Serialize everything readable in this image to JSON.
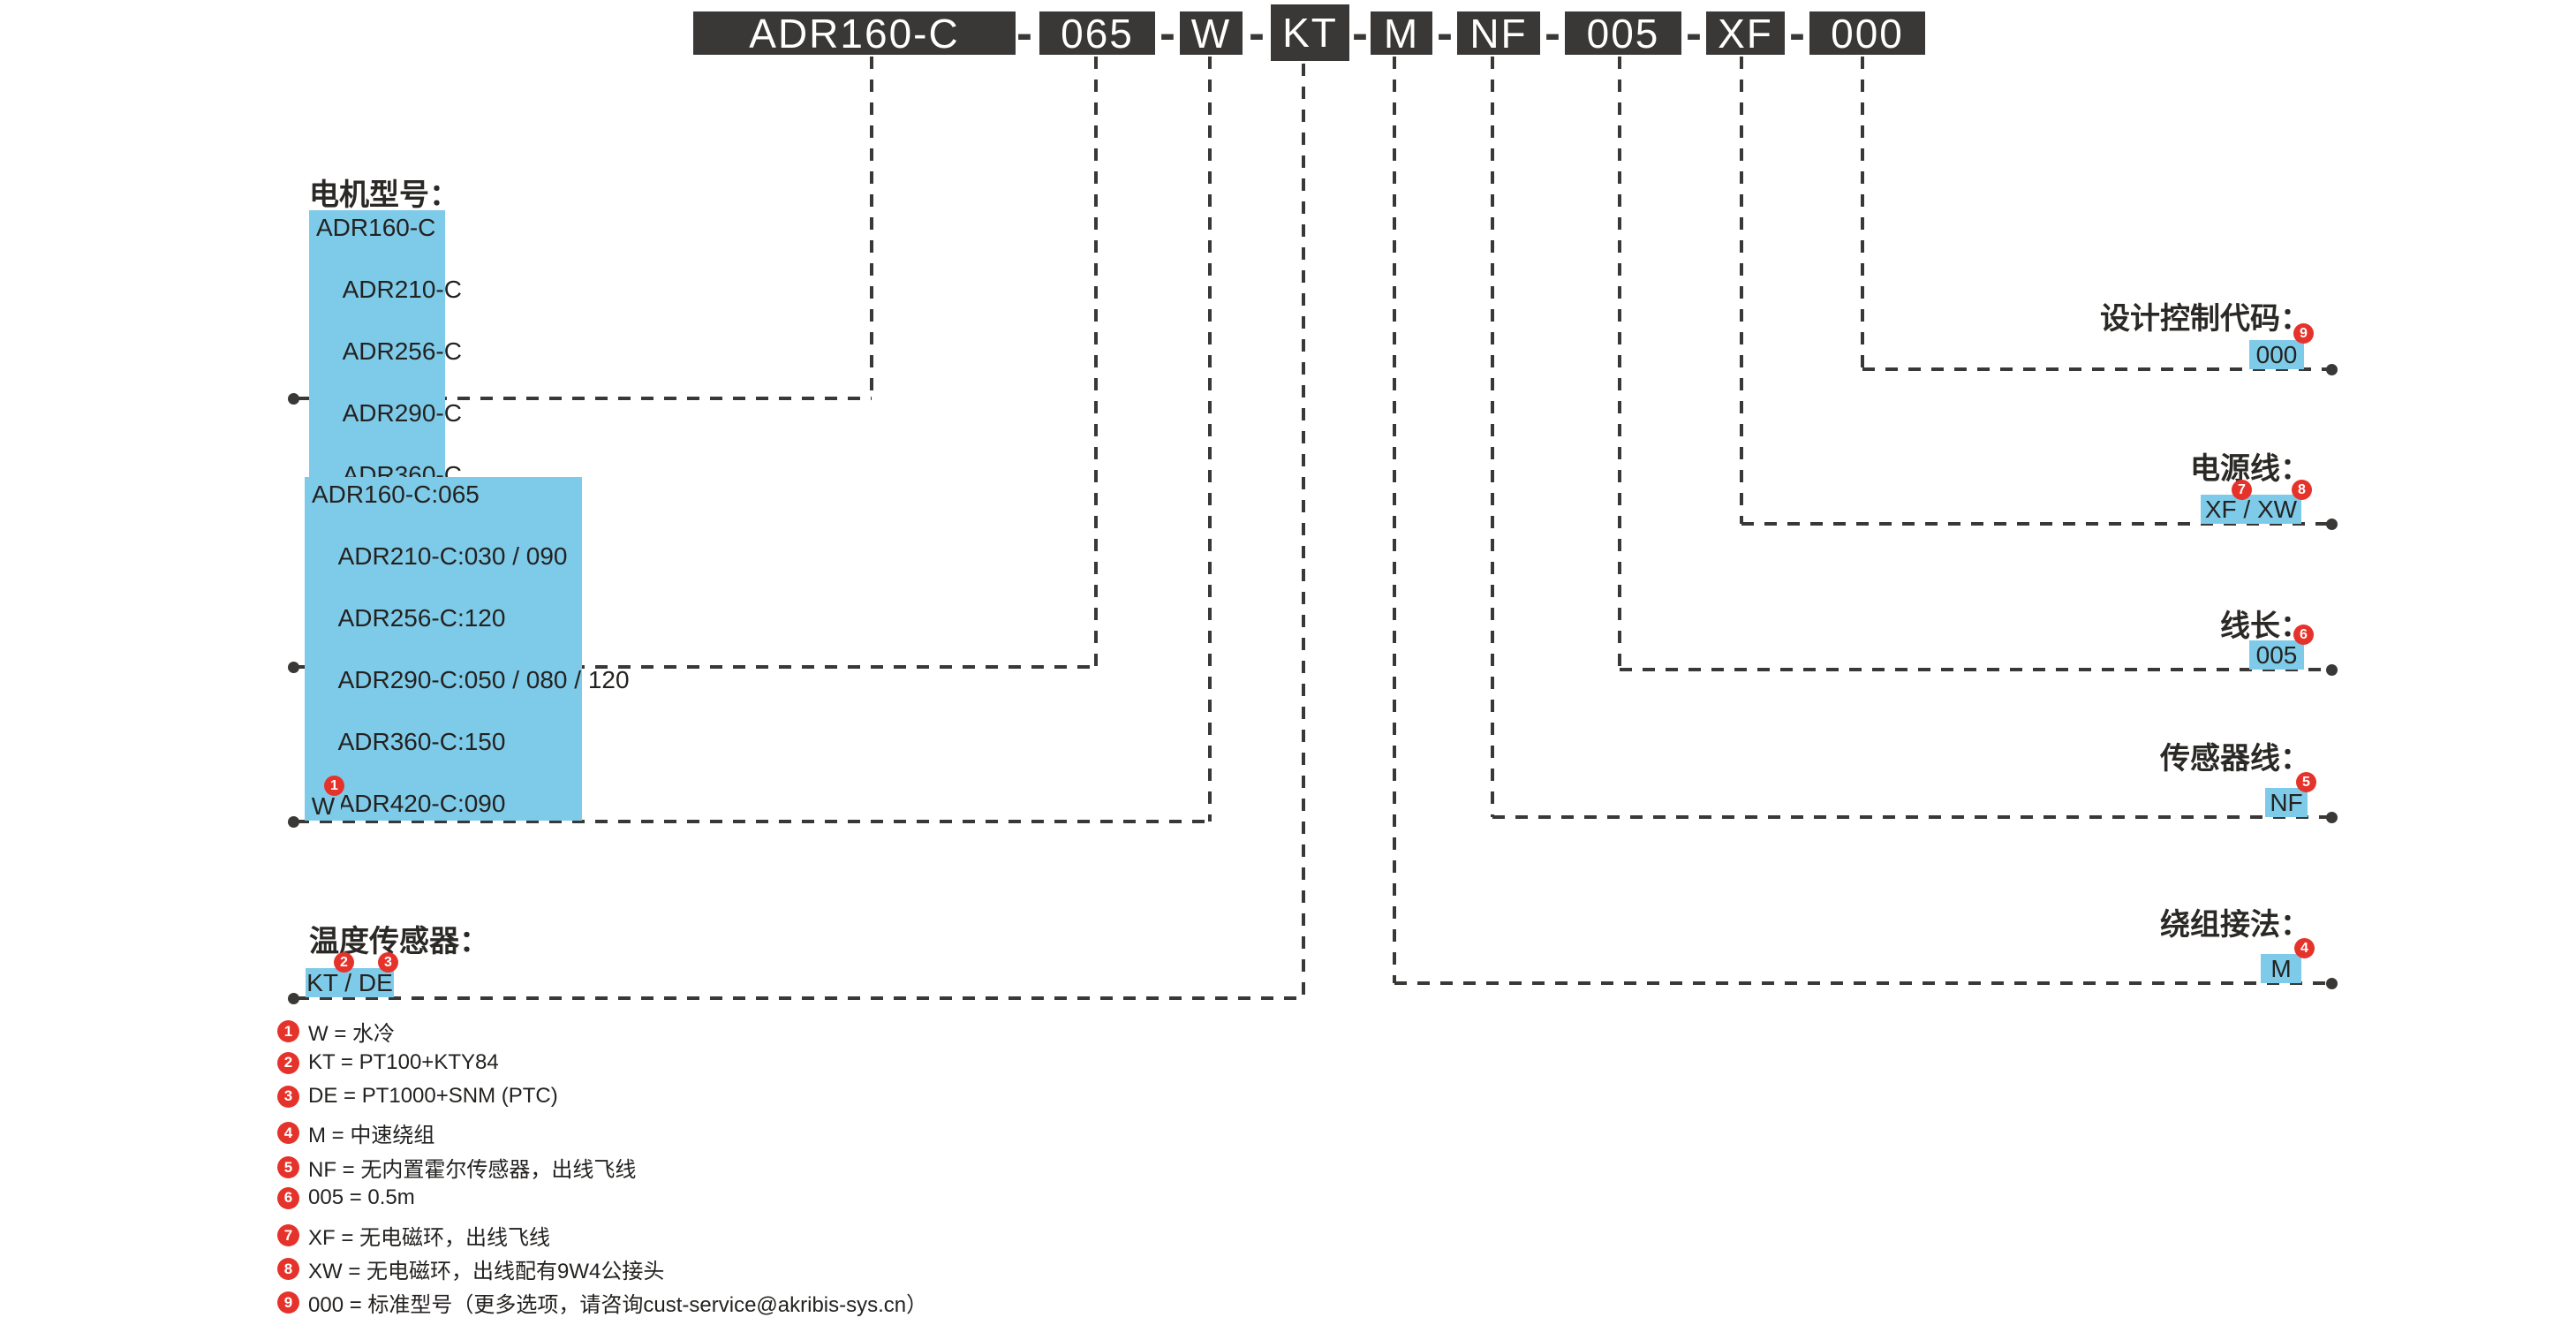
{
  "colors": {
    "segment_dark": "#3a3836",
    "highlight_blue": "#7ecbe9",
    "badge_red": "#e5332b",
    "text": "#2b2926",
    "background": "#ffffff"
  },
  "title": {
    "full_code": "ADR160-C-065-W-KT-M-NF-005-XF-000",
    "separator": "-",
    "segments": [
      {
        "text": "ADR160-C"
      },
      {
        "text": "065"
      },
      {
        "text": "W"
      },
      {
        "text": "KT"
      },
      {
        "text": "M"
      },
      {
        "text": "NF"
      },
      {
        "text": "005"
      },
      {
        "text": "XF"
      },
      {
        "text": "000"
      }
    ]
  },
  "left_sections": {
    "motor_model": {
      "label": "电机型号：",
      "items": [
        "ADR160-C",
        "ADR210-C",
        "ADR256-C",
        "ADR290-C",
        "ADR360-C",
        "ADR420-C"
      ]
    },
    "core_height": {
      "label": "铁芯高度：",
      "items": [
        "ADR160-C:065",
        "ADR210-C:030 / 090",
        "ADR256-C:120",
        "ADR290-C:050 / 080 / 120",
        "ADR360-C:150",
        "ADR420-C:090"
      ]
    },
    "cooling": {
      "label": "冷却方式：",
      "value": "W",
      "badge": "1"
    },
    "temp_sensor": {
      "label": "温度传感器：",
      "value": "KT / DE",
      "badge_kt": "2",
      "badge_de": "3"
    }
  },
  "right_sections": {
    "design_code": {
      "label": "设计控制代码：",
      "value": "000",
      "badge": "9"
    },
    "power_cable": {
      "label": "电源线：",
      "value": "XF / XW",
      "badge_xf": "7",
      "badge_xw": "8"
    },
    "cable_length": {
      "label": "线长：",
      "value": "005",
      "badge": "6"
    },
    "sensor_cable": {
      "label": "传感器线：",
      "value": "NF",
      "badge": "5"
    },
    "winding": {
      "label": "绕组接法：",
      "value": "M",
      "badge": "4"
    }
  },
  "legend": [
    {
      "num": "1",
      "text": "W = 水冷"
    },
    {
      "num": "2",
      "text": "KT = PT100+KTY84"
    },
    {
      "num": "3",
      "text": "DE = PT1000+SNM (PTC)"
    },
    {
      "num": "4",
      "text": "M = 中速绕组"
    },
    {
      "num": "5",
      "text": "NF = 无内置霍尔传感器，出线飞线"
    },
    {
      "num": "6",
      "text": "005 = 0.5m"
    },
    {
      "num": "7",
      "text": "XF = 无电磁环，出线飞线"
    },
    {
      "num": "8",
      "text": "XW = 无电磁环，出线配有9W4公接头"
    },
    {
      "num": "9",
      "text": "000 = 标准型号（更多选项，请咨询cust-service@akribis-sys.cn）"
    }
  ]
}
